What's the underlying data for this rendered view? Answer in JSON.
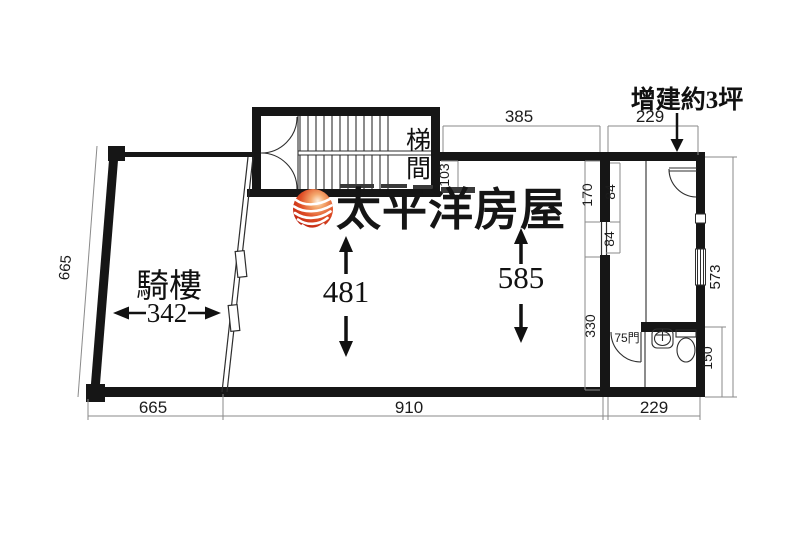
{
  "title": "floor-plan",
  "background": "#ffffff",
  "colors": {
    "wall": "#161616",
    "line": "#2e2e2e",
    "dim_line": "#8a8a8a",
    "dim_text": "#1c1c1c",
    "logo_red": "#cf2a12",
    "logo_red_dark": "#8f170a",
    "logo_highlight": "#f9d9b8"
  },
  "labels": {
    "stairwell": "梯間",
    "arcade": "騎樓",
    "annex": "增建約3坪",
    "bath_door": "75門",
    "brand": "太平洋房屋"
  },
  "dims": {
    "top_main_width": "385",
    "top_annex_width": "229",
    "stair_clear": "103",
    "wall_upper": "170",
    "window_a": "84",
    "window_b": "84",
    "wall_lower": "330",
    "right_total": "573",
    "bath_height": "150",
    "left_side": "665",
    "bottom_left": "665",
    "bottom_main": "910",
    "bottom_annex": "229",
    "room_width": "481",
    "room_depth": "585",
    "arcade_width": "342"
  }
}
